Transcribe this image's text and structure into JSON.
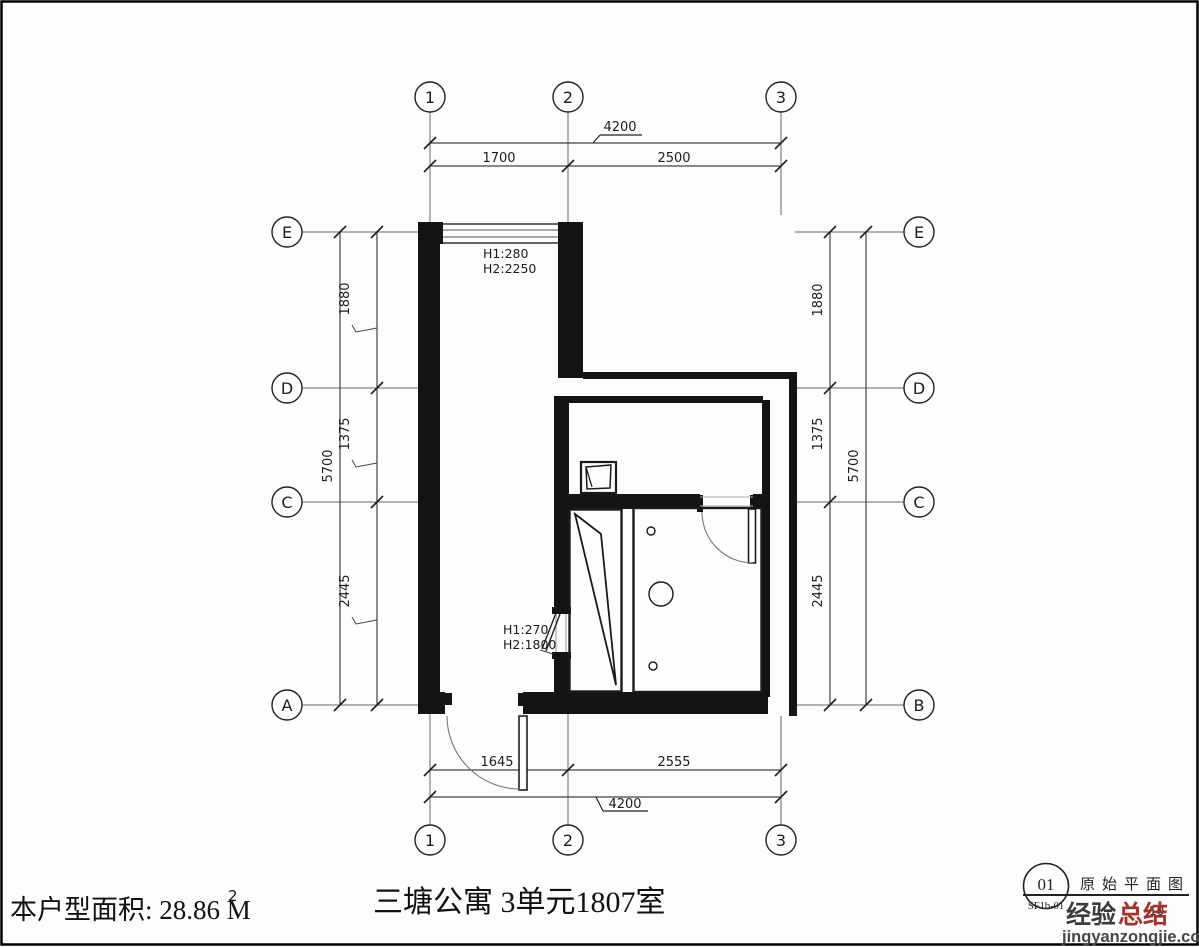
{
  "grid": {
    "cols": [
      "1",
      "2",
      "3"
    ],
    "rows_left": [
      "E",
      "D",
      "C",
      "A"
    ],
    "rows_right": [
      "E",
      "D",
      "C",
      "B"
    ]
  },
  "dims": {
    "top_overall": "4200",
    "top_segments": [
      "1700",
      "2500"
    ],
    "bottom_segments": [
      "1645",
      "2555"
    ],
    "bottom_overall": "4200",
    "left_segments": [
      "1880",
      "1375",
      "2445"
    ],
    "left_overall": "5700",
    "right_segments": [
      "1880",
      "1375",
      "2445"
    ],
    "right_overall": "5700"
  },
  "annotations": {
    "top_window": {
      "l1": "H1:280",
      "l2": "H2:2250"
    },
    "mid_window": {
      "l1": "H1:270",
      "l2": "H2:1800"
    }
  },
  "footer": {
    "area_label": "本户型面积: 28.86 M",
    "area_sup": "2",
    "title": "三塘公寓  3单元1807室"
  },
  "titleblock": {
    "number": "01",
    "code": "SF1b-01",
    "drawing_name": "原始平面图",
    "scale_fragment": "10",
    "logo_black": "经验",
    "logo_red": "总结",
    "site": "jingyanzongjie.com",
    "color_red": "#a4322b",
    "color_dark": "#3c3c3c",
    "color_site": "#474747"
  }
}
